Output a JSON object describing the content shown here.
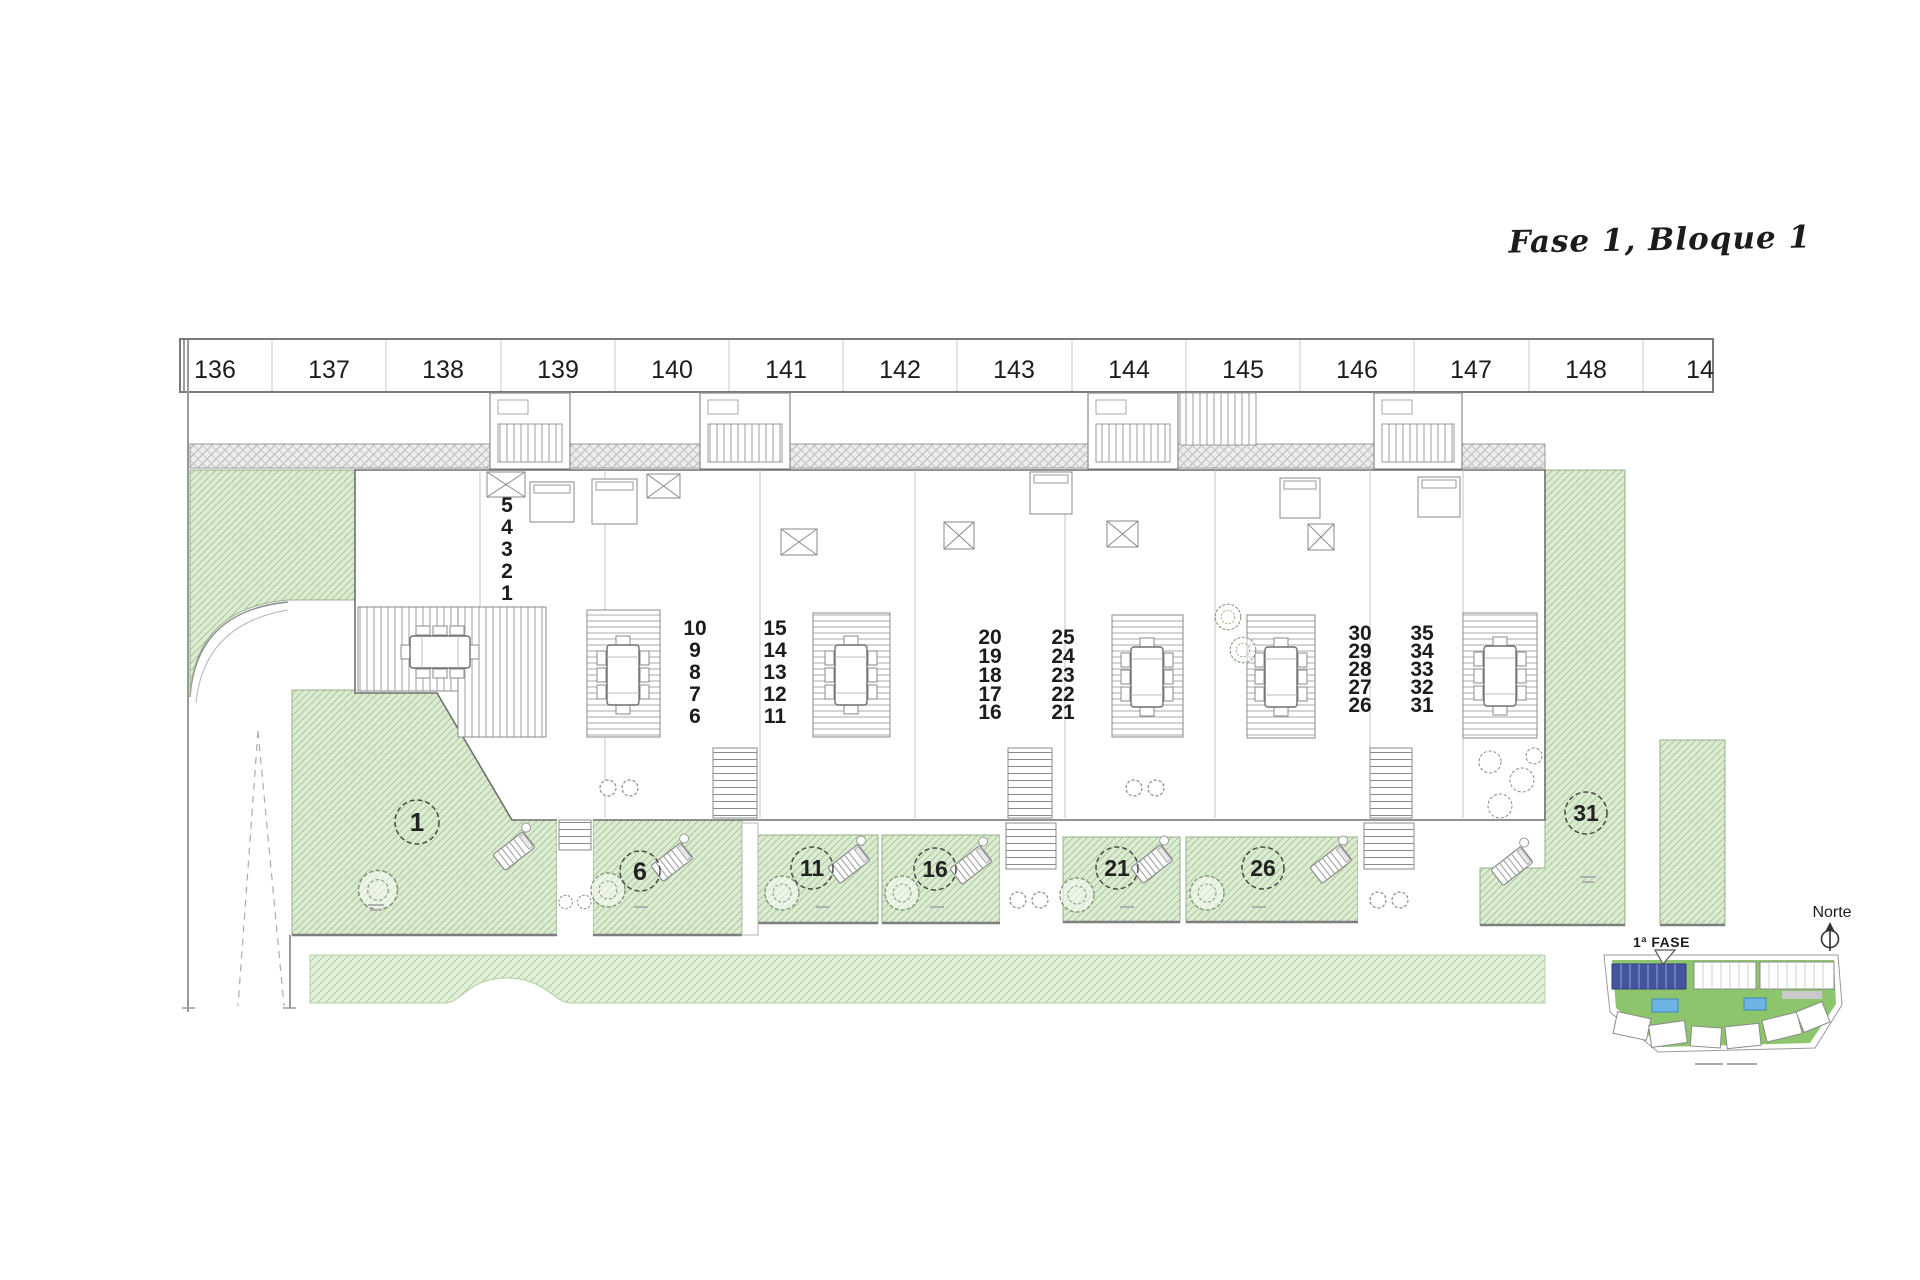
{
  "title": "Fase 1, Bloque 1",
  "parking": {
    "spaces": [
      "136",
      "137",
      "138",
      "139",
      "140",
      "141",
      "142",
      "143",
      "144",
      "145",
      "146",
      "147",
      "148",
      "14"
    ]
  },
  "units": {
    "stacks": [
      {
        "numbers": [
          "5",
          "4",
          "3",
          "2",
          "1"
        ]
      },
      {
        "numbers": [
          "10",
          "9",
          "8",
          "7",
          "6"
        ]
      },
      {
        "numbers": [
          "15",
          "14",
          "13",
          "12",
          "11"
        ]
      },
      {
        "numbers": [
          "20",
          "19",
          "18",
          "17",
          "16"
        ]
      },
      {
        "numbers": [
          "25",
          "24",
          "23",
          "22",
          "21"
        ]
      },
      {
        "numbers": [
          "30",
          "29",
          "28",
          "27",
          "26"
        ]
      },
      {
        "numbers": [
          "35",
          "34",
          "33",
          "32",
          "31"
        ]
      }
    ],
    "gardens": [
      {
        "label": "1"
      },
      {
        "label": "6"
      },
      {
        "label": "11"
      },
      {
        "label": "16"
      },
      {
        "label": "21"
      },
      {
        "label": "26"
      },
      {
        "label": "31"
      }
    ]
  },
  "legend": {
    "phase_label": "1ª FASE",
    "north_label": "Norte"
  },
  "colors": {
    "garden_green": "#dcecd2",
    "garden_hatch": "#a9c898",
    "roof_hatch": "#bdbdbd",
    "line_gray": "#8a8a8a",
    "minimap_green": "#8cc56b",
    "minimap_blue_block": "#44549e",
    "minimap_pool": "#6db4e4"
  }
}
